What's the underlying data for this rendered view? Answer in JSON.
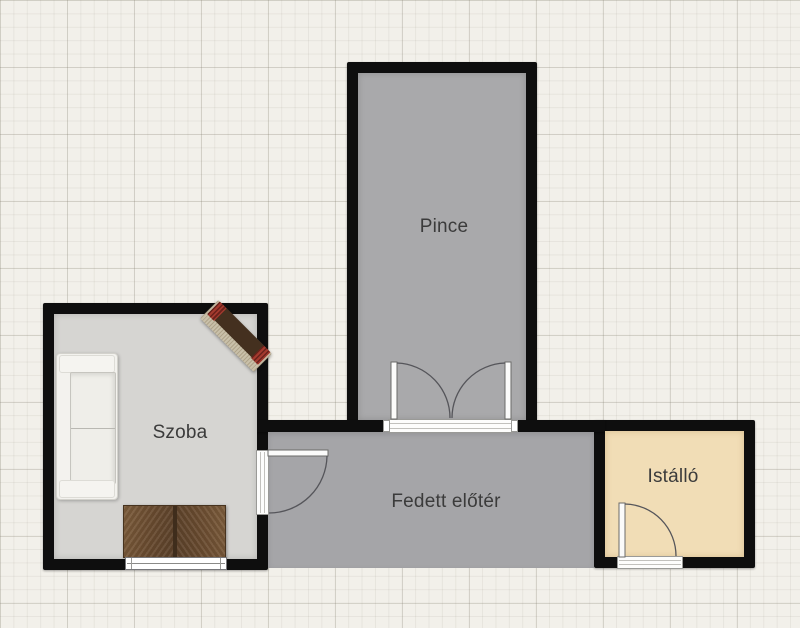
{
  "plan": {
    "type": "floor-plan",
    "rooms": [
      {
        "id": "pince",
        "label": "Pince",
        "floor_color": "#a9a9ab"
      },
      {
        "id": "szoba",
        "label": "Szoba",
        "floor_color": "#d6d5d2"
      },
      {
        "id": "fedett-eloter",
        "label": "Fedett előtér",
        "floor_color": "#a5a5a8"
      },
      {
        "id": "istallo",
        "label": "Istálló",
        "floor_color": "#f1ddb6"
      }
    ],
    "openings": [
      {
        "id": "pince-double-door",
        "type": "double-door",
        "wall": "pince-south"
      },
      {
        "id": "szoba-door",
        "type": "door",
        "wall": "szoba-east"
      },
      {
        "id": "szoba-window",
        "type": "window",
        "wall": "szoba-south"
      },
      {
        "id": "istallo-door",
        "type": "door",
        "wall": "istallo-south"
      }
    ],
    "furniture": [
      {
        "id": "sofa",
        "name": "white sofa"
      },
      {
        "id": "sideboard",
        "name": "wooden sideboard"
      },
      {
        "id": "bench",
        "name": "bench with red cushions"
      }
    ],
    "colors": {
      "background": "#f2f0ea",
      "grid_minor": "#e8e6df",
      "grid_major": "#dcdad3",
      "wall": "#0e0e0e",
      "door_stroke": "#5a5a5a"
    }
  }
}
